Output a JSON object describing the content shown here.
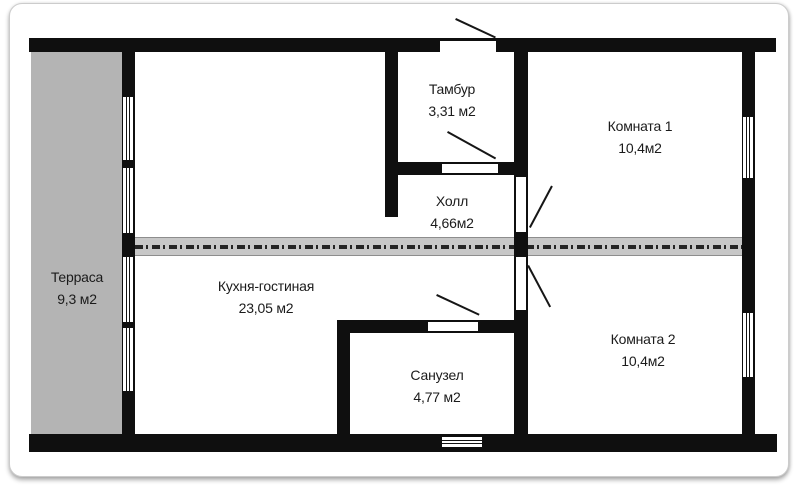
{
  "plan": {
    "title": "Apartment floor plan",
    "rooms": [
      {
        "id": "terrace",
        "name": "Терраса",
        "area": "9,3 м2"
      },
      {
        "id": "tambour",
        "name": "Тамбур",
        "area": "3,31 м2"
      },
      {
        "id": "hall",
        "name": "Холл",
        "area": "4,66м2"
      },
      {
        "id": "room1",
        "name": "Комната 1",
        "area": "10,4м2"
      },
      {
        "id": "kitchen-living",
        "name": "Кухня-гостиная",
        "area": "23,05 м2"
      },
      {
        "id": "bathroom",
        "name": "Санузел",
        "area": "4,77 м2"
      },
      {
        "id": "room2",
        "name": "Комната 2",
        "area": "10,4м2"
      }
    ],
    "symbols": {
      "window": "double-line-window-symbol",
      "door": "arc-swing-door-symbol",
      "partition": "dash-dot-partition-band"
    },
    "colors": {
      "wall": "#0f0f0f",
      "terrace_fill": "#b4b4b4",
      "partition_band": "#c7c7c7",
      "background": "#ffffff"
    }
  }
}
